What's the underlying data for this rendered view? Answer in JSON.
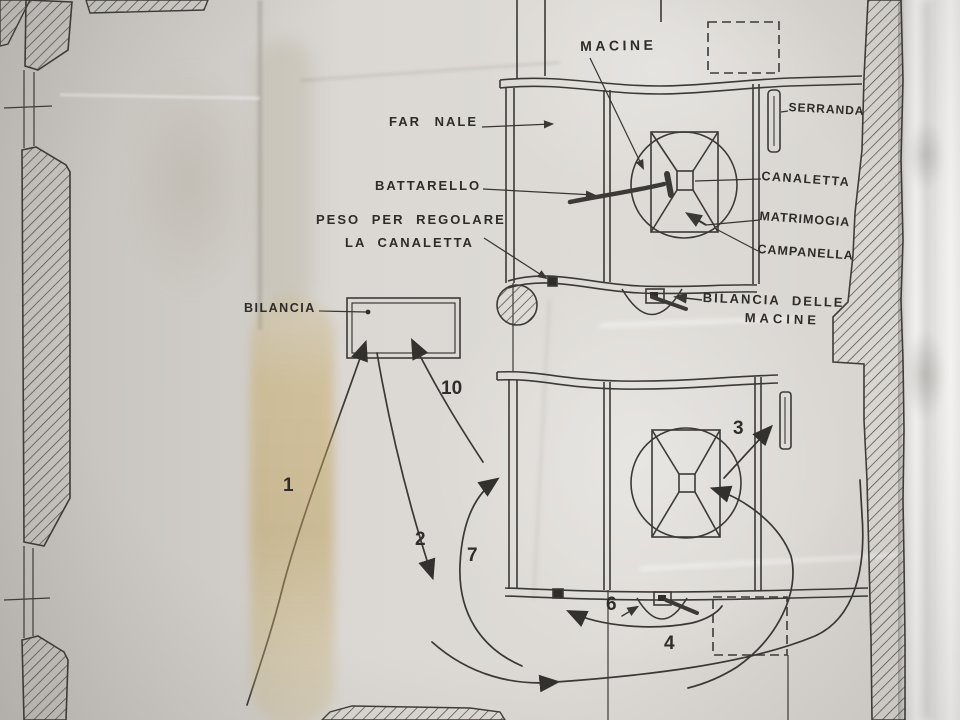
{
  "document": {
    "kind": "photograph of a hand-drafted mill diagram on creased paper",
    "labels": {
      "macine": "MACINE",
      "farnale": "FAR NALE",
      "battarello": "BATTARELLO",
      "peso_line1": "PESO PER REGOLARE",
      "peso_line2": "LA CANALETTA",
      "bilancia": "BILANCIA",
      "serranda": "SERRANDA",
      "canaletta": "CANALETTA",
      "matrimogia": "MATRIMOGIA",
      "campanella": "CAMPANELLA",
      "bilancia_delle_macine_line1": "BILANCIA DELLE",
      "bilancia_delle_macine_line2": "MACINE"
    },
    "flow_numbers": {
      "n1": "1",
      "n2": "2",
      "n3": "3",
      "n4": "4",
      "n6": "6",
      "n7": "7",
      "n10": "10"
    },
    "colors": {
      "ink": "#3c3a37",
      "paper_light": "#dedbd6",
      "paper_shadow": "#c2bfba",
      "paper_bright_edge": "#f7f6f4",
      "stain": "#c3a068"
    }
  }
}
